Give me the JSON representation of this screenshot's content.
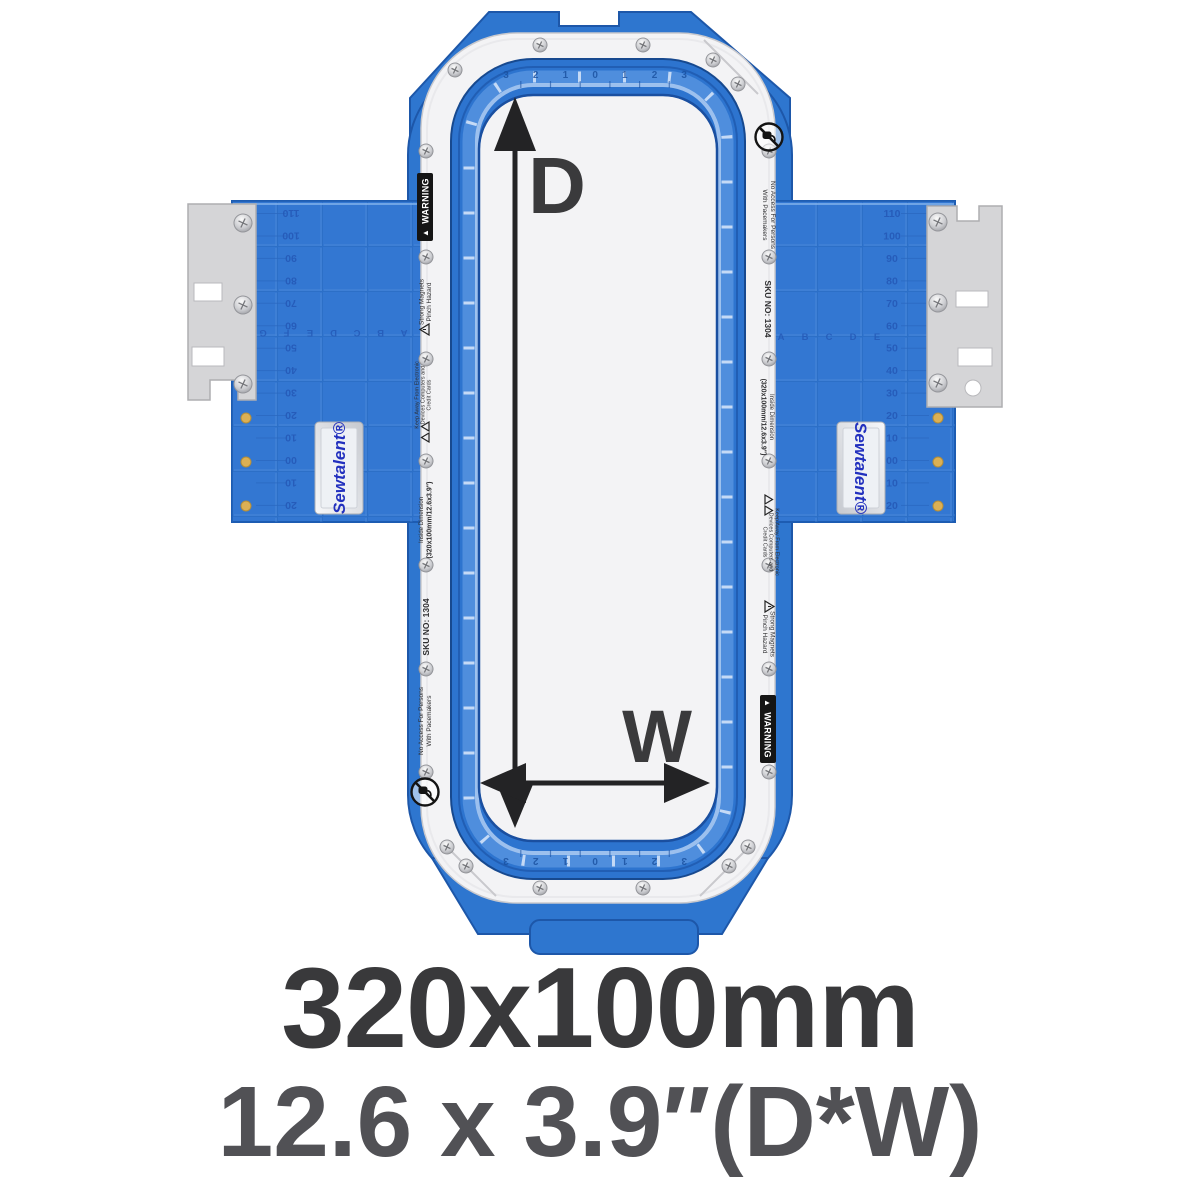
{
  "product": {
    "brand": "Sewtalent®",
    "dimension_label_depth": "D",
    "dimension_label_width": "W"
  },
  "caption": {
    "line1": "320x100mm",
    "line2": "12.6 x 3.9″(D*W)"
  },
  "ring_labels": {
    "warning": "WARNING",
    "strong_magnets": [
      "Strong Magnets",
      "Pinch Hazard"
    ],
    "keep_away": [
      "Keep Away From Electronic",
      "Devices Computers and",
      "Credit Cards"
    ],
    "inside_dimension": [
      "Inside Dimension",
      "(320x100mm/12.6x3.9\")"
    ],
    "sku": "SKU NO: 1304",
    "no_access": [
      "No Access For Persons",
      "With Pacemakers"
    ]
  },
  "rulers": {
    "wing_values": [
      "110",
      "100",
      "90",
      "80",
      "70",
      "60",
      "50",
      "40",
      "30",
      "20",
      "10",
      "00",
      "10",
      "20"
    ],
    "left_wing_letters": [
      "G",
      "F",
      "E",
      "D",
      "C",
      "B",
      "A"
    ],
    "right_wing_letters": [
      "A",
      "B",
      "C",
      "D",
      "E"
    ],
    "hoop_values": [
      "3",
      "2",
      "1",
      "0",
      "1",
      "2",
      "3"
    ]
  },
  "icons": {
    "warning_triangle": "▲"
  },
  "colors": {
    "frame_blue": "#2e76cf",
    "wing_blue": "#3377d2",
    "hoop_edge_blue": "#17498f",
    "ring_white": "#f3f3f5",
    "bracket_gray": "#d5d5d7",
    "gold_pin": "#dcb054",
    "brand_blue": "#2230be",
    "caption_dark": "#39393b",
    "caption_gray": "#515155",
    "arrow_black": "#232325"
  }
}
